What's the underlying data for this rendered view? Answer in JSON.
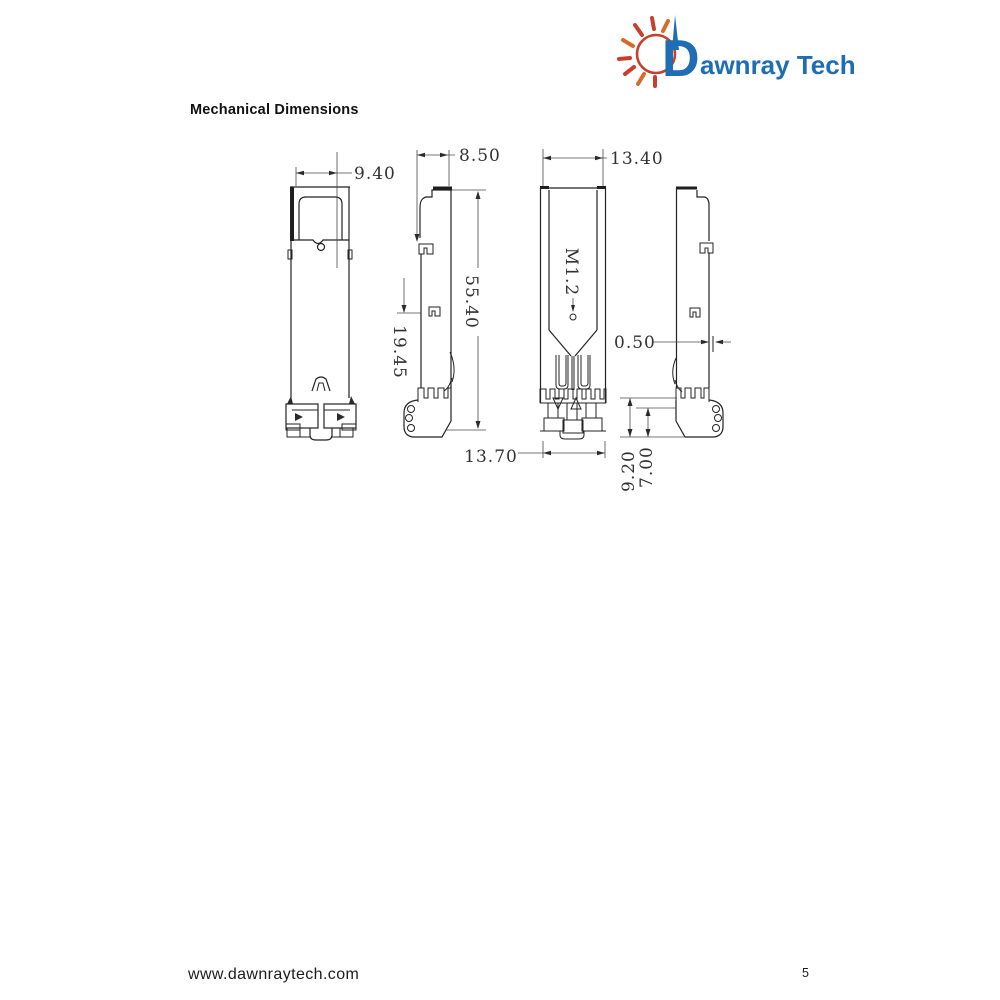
{
  "logo": {
    "initial": "D",
    "rest": "awnray Tech",
    "brand_color": "#1e6db5",
    "sun_color": "#c7402e",
    "sun_alt_color": "#d96a29"
  },
  "page": {
    "title": "Mechanical Dimensions",
    "footer_url": "www.dawnraytech.com",
    "page_number": "5"
  },
  "drawing": {
    "line_color": "#232323",
    "dim_color": "#4a4a4a",
    "dimensions": {
      "cage_width": "9.40",
      "side_top_width": "8.50",
      "overall_length": "55.40",
      "upper_section_length": "19.45",
      "connector_width": "13.70",
      "body_width": "13.40",
      "thread_label": "M1.2",
      "wall_thickness": "0.50",
      "foot_height_outer": "9.20",
      "foot_height_inner": "7.00"
    }
  }
}
